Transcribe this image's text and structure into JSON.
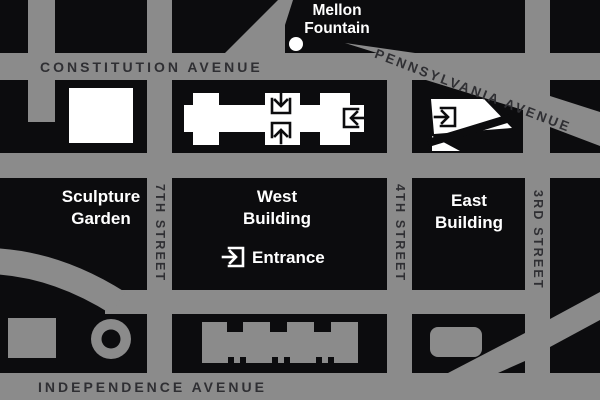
{
  "labels": {
    "fountain_line1": "Mellon",
    "fountain_line2": "Fountain",
    "constitution": "CONSTITUTION AVENUE",
    "pennsylvania": "PENNSYLVANIA AVENUE",
    "independence": "INDEPENDENCE AVENUE",
    "street_7th": "7TH STREET",
    "street_4th": "4TH STREET",
    "street_3rd": "3RD STREET",
    "sculpture_line1": "Sculpture",
    "sculpture_line2": "Garden",
    "west_line1": "West",
    "west_line2": "Building",
    "east_line1": "East",
    "east_line2": "Building",
    "entrance": "Entrance"
  },
  "colors": {
    "street_gray": "#8B8B8B",
    "block_black": "#0C0C0E",
    "avenue_text": "#2F2F33",
    "building_white": "#FFFFFF"
  },
  "icons": {
    "fountain_dot": "mellon-fountain-dot",
    "west_north_entrance": "entrance-arrow-down-icon",
    "west_south_entrance": "entrance-arrow-up-icon",
    "west_east_entrance": "entrance-arrow-left-icon",
    "east_building_entrance": "entrance-arrow-right-icon",
    "legend_entrance": "entrance-legend-icon"
  }
}
